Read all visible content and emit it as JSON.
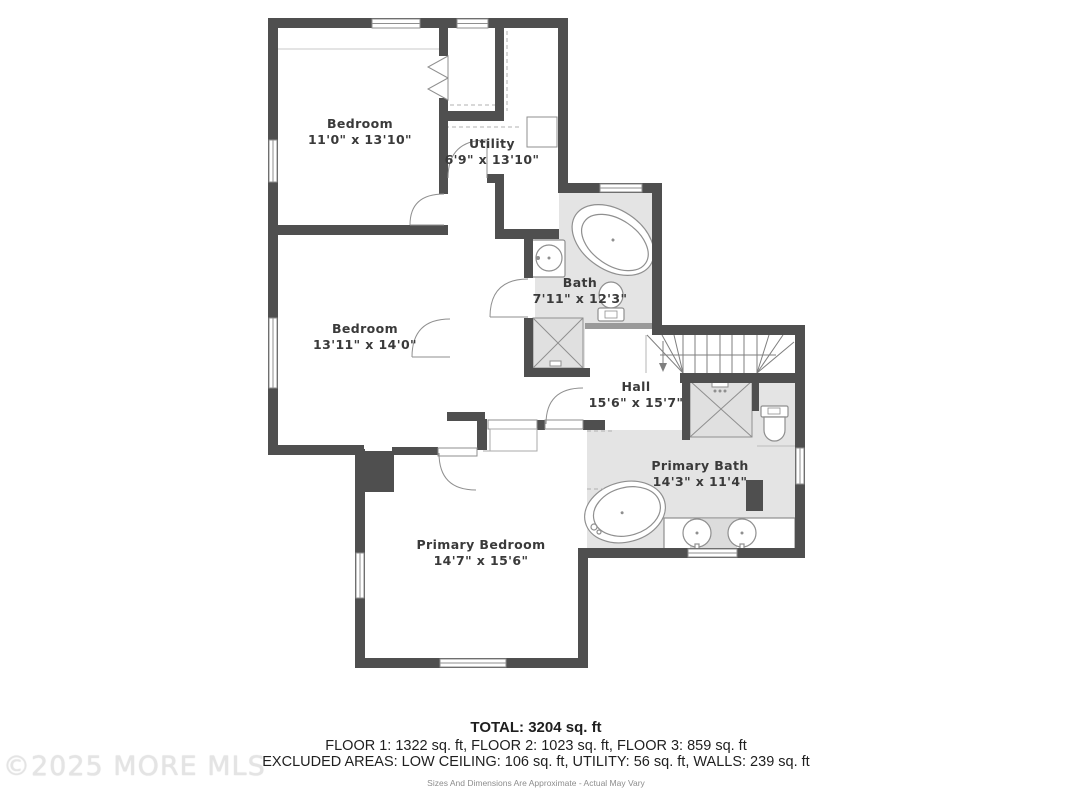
{
  "floor_plan": {
    "rooms": [
      {
        "label": "Bedroom",
        "dims": "11'0\" x 13'10\""
      },
      {
        "label": "Utility",
        "dims": "6'9\" x 13'10\""
      },
      {
        "label": "Bedroom",
        "dims": "13'11\" x 14'0\""
      },
      {
        "label": "Bath",
        "dims": "7'11\" x 12'3\""
      },
      {
        "label": "Hall",
        "dims": "15'6\" x 15'7\""
      },
      {
        "label": "Primary Bath",
        "dims": "14'3\" x 11'4\""
      },
      {
        "label": "Primary Bedroom",
        "dims": "14'7\" x 15'6\""
      }
    ],
    "fixtures": [
      "bathtub",
      "sink",
      "toilet",
      "shower",
      "double-vanity",
      "stairs"
    ]
  },
  "summary": {
    "total_line": "TOTAL: 3204 sq. ft",
    "floors_line": "FLOOR 1: 1322 sq. ft, FLOOR 2: 1023 sq. ft, FLOOR 3: 859 sq. ft",
    "excluded_line": "EXCLUDED AREAS: LOW CEILING: 106 sq. ft, UTILITY: 56 sq. ft, WALLS: 239 sq. ft",
    "disclaimer": "Sizes And Dimensions Are Approximate - Actual May Vary"
  },
  "watermark": "©2025 MORE MLS",
  "colors": {
    "wall": "#4f4f4f",
    "shaded_floor": "#e4e4e4",
    "fixture_stroke": "#8f8f8f",
    "label_text": "#3a3a3a",
    "watermark_text": "#e4e4e4"
  }
}
